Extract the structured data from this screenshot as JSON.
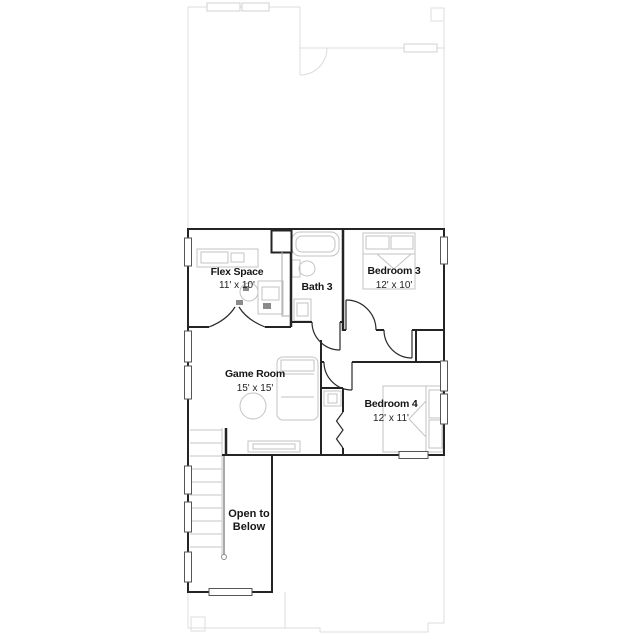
{
  "rooms": {
    "flex": {
      "name": "Flex Space",
      "dims": "11' x 10'"
    },
    "bath3": {
      "name": "Bath 3"
    },
    "bedroom3": {
      "name": "Bedroom 3",
      "dims": "12' x 10'"
    },
    "game_room": {
      "name": "Game Room",
      "dims": "15' x 15'"
    },
    "bedroom4": {
      "name": "Bedroom 4",
      "dims": "12' x 11'"
    },
    "open_to_below": {
      "line1": "Open to",
      "line2": "Below"
    }
  },
  "colors": {
    "wall": "#242424",
    "faint_outline": "#dcdcdc",
    "furniture": "#c3c3c3",
    "stairs": "#c6c6c6",
    "railing": "#8c8c8c",
    "window_frame": "#555555",
    "label_text": "#161616"
  }
}
